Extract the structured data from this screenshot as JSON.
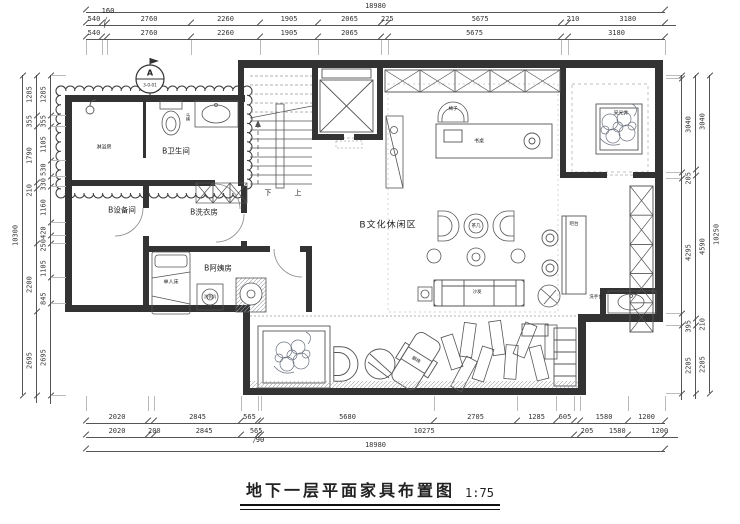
{
  "title": {
    "text": "地下一层平面家具布置图",
    "scale": "1:75"
  },
  "section_marker": {
    "label": "A",
    "code": "3-0-01"
  },
  "stairs": {
    "down": "下",
    "up": "上"
  },
  "rooms": {
    "bathroom": "B卫生间",
    "shower": "淋浴房",
    "equipment": "B设备间",
    "laundry": "B洗衣房",
    "nanny": "B阿姨房",
    "leisure": "B文化休闲区",
    "lightwell": "采光井",
    "washstand": "洗手台",
    "bar": "吧台"
  },
  "furniture": {
    "bed": "单人床",
    "washer": "洗衣机",
    "toilet": "马桶",
    "desk": "书桌",
    "chair": "椅子",
    "tea_table": "茶几",
    "sofa": "沙发",
    "lounge": "躺椅"
  },
  "dimensions": {
    "top": {
      "overall": [
        "18980"
      ],
      "leader": "160",
      "row1": [
        "540",
        "",
        "2760",
        "2260",
        "1905",
        "2065",
        "225",
        "5675",
        "210",
        "3180"
      ],
      "row2": [
        "540",
        "",
        "2760",
        "2260",
        "1905",
        "2065",
        "",
        "5675",
        "",
        "3180"
      ]
    },
    "bottom": {
      "leader": "90",
      "row1": [
        "2020",
        "",
        "2845",
        "565",
        "",
        "5680",
        "2705",
        "1285",
        "605",
        "",
        "1580",
        "1200"
      ],
      "row2": [
        "2020",
        "200",
        "2845",
        "565",
        "",
        "10275",
        "205",
        "1580",
        "1200"
      ],
      "overall": [
        "18980"
      ]
    },
    "left": {
      "outer": [
        "10300"
      ],
      "mid": [
        "1285",
        "355",
        "1790",
        "210",
        "",
        "2200",
        "2695"
      ],
      "inner": [
        "1285",
        "355",
        "1105",
        "530",
        "330",
        "1160",
        "420",
        "250",
        "1105",
        "845",
        "2695"
      ]
    },
    "right": {
      "outer": [
        "10250"
      ],
      "mid": [
        "3040",
        "",
        "4590",
        "210",
        "2205"
      ],
      "inner": [
        "",
        "3040",
        "205",
        "4295",
        "395",
        "2205"
      ]
    }
  }
}
